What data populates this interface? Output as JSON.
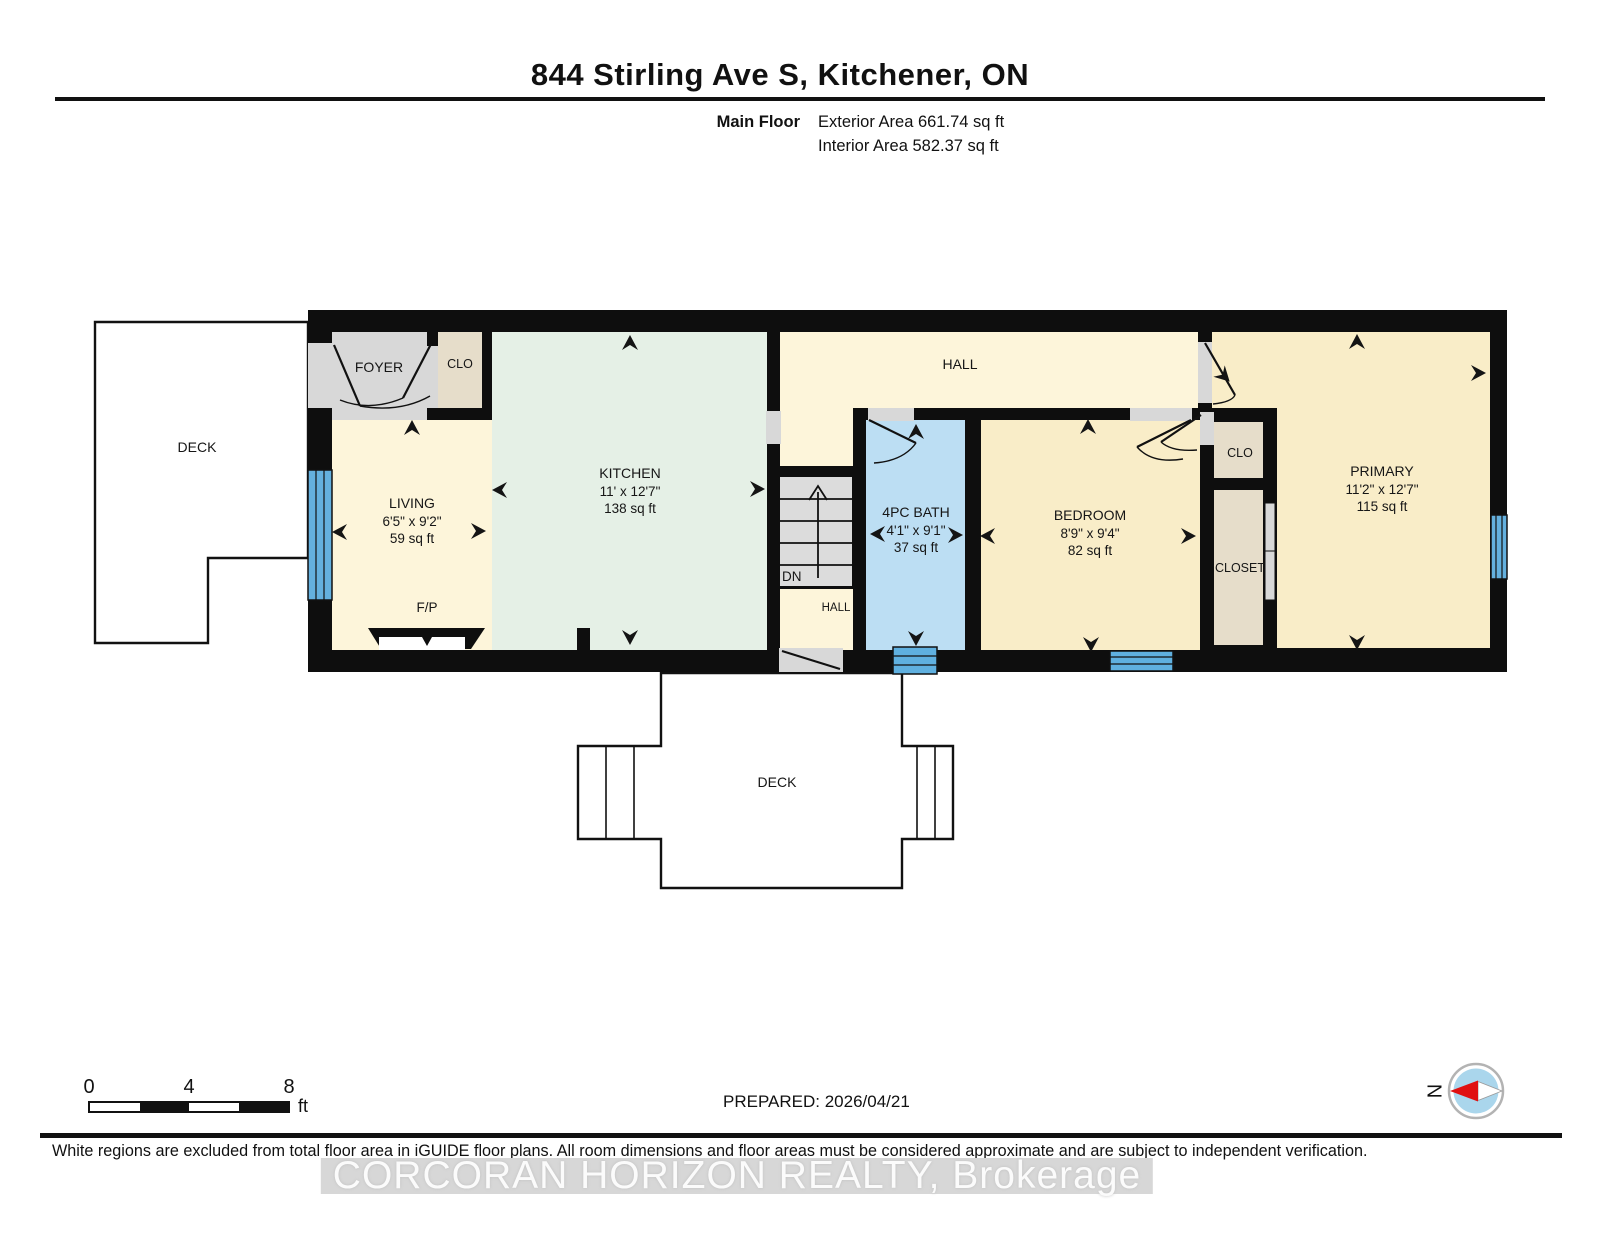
{
  "header": {
    "title": "844 Stirling Ave S, Kitchener, ON",
    "floor_label": "Main Floor",
    "exterior_area": "Exterior Area 661.74 sq ft",
    "interior_area": "Interior Area 582.37 sq ft"
  },
  "plan": {
    "rooms": {
      "deck_left": {
        "name": "DECK"
      },
      "foyer": {
        "name": "FOYER"
      },
      "entry_closet": {
        "name": "CLO"
      },
      "living": {
        "name": "LIVING",
        "dims": "6'5\" x 9'2\"",
        "area": "59 sq ft"
      },
      "fireplace": {
        "name": "F/P"
      },
      "kitchen": {
        "name": "KITCHEN",
        "dims": "11' x 12'7\"",
        "area": "138 sq ft"
      },
      "hall": {
        "name": "HALL"
      },
      "stairs": {
        "name": "DN"
      },
      "hall_lower": {
        "name": "HALL"
      },
      "bath": {
        "name": "4PC BATH",
        "dims": "4'1\" x 9'1\"",
        "area": "37 sq ft"
      },
      "bedroom": {
        "name": "BEDROOM",
        "dims": "8'9\" x 9'4\"",
        "area": "82 sq ft"
      },
      "bedroom_closet": {
        "name": "CLO"
      },
      "primary_closet": {
        "name": "CLOSET"
      },
      "primary": {
        "name": "PRIMARY",
        "dims": "11'2\" x 12'7\"",
        "area": "115 sq ft"
      },
      "deck_bottom": {
        "name": "DECK"
      }
    },
    "colors": {
      "wall": "#0e0e0e",
      "hall_cream": "#fdf5da",
      "bedroom_cream": "#f9edc8",
      "kitchen_mint": "#e5f0e6",
      "bath_blue": "#bcdef3",
      "window_blue": "#64b0de",
      "door_gray": "#d8d8d8",
      "closet_beige": "#e6ddca",
      "compass_blue": "#aad6ec",
      "compass_red": "#e01010"
    }
  },
  "footer": {
    "scale": {
      "tick0": "0",
      "tick1": "4",
      "tick2": "8",
      "unit": "ft"
    },
    "prepared": "PREPARED: 2026/04/21",
    "compass": "N",
    "disclaimer": "White regions are excluded from total floor area in iGUIDE floor plans. All room dimensions and floor areas must be considered approximate and are subject to independent verification.",
    "watermark": "CORCORAN HORIZON REALTY, Brokerage"
  }
}
